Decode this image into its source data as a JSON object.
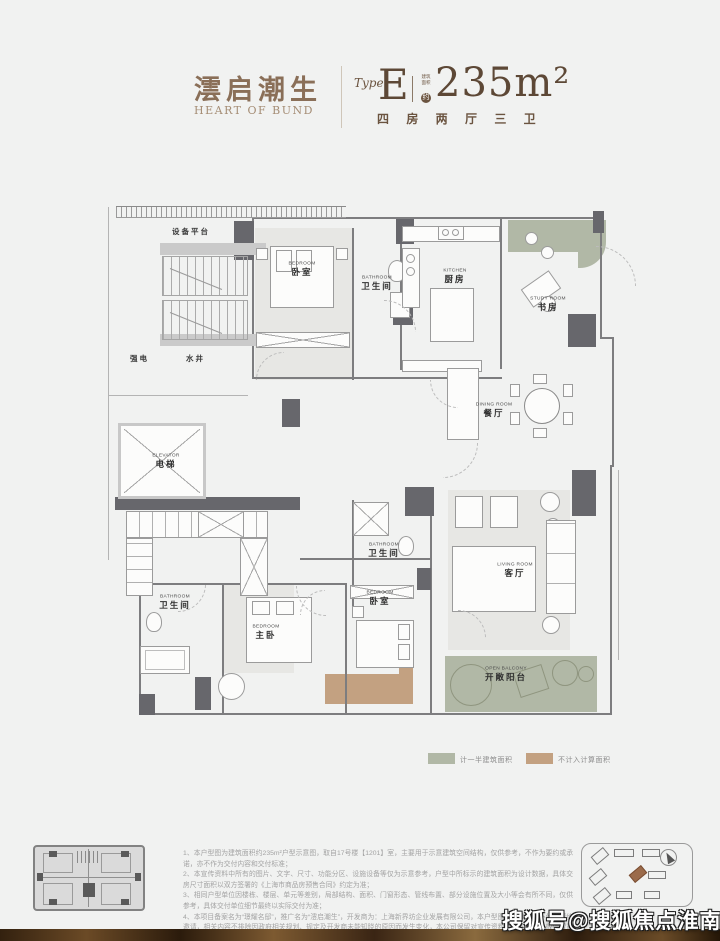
{
  "header": {
    "title_cn": "澐启潮生",
    "subtitle_en": "HEART OF BUND",
    "type_label": "Type",
    "type_value": "E",
    "area_badge_line1": "建筑",
    "area_badge_line2": "面积",
    "area_badge_circle": "约",
    "area_value": "235m²",
    "layout_desc": "四 房 两 厅 三 卫"
  },
  "plan": {
    "annotations": {
      "equipment_platform": "设备平台",
      "strong_electric": "强电",
      "water_well": "水井"
    },
    "rooms": [
      {
        "en": "BEDROOM",
        "cn": "卧室"
      },
      {
        "en": "BATHROOM",
        "cn": "卫生间"
      },
      {
        "en": "KITCHEN",
        "cn": "厨房"
      },
      {
        "en": "STUDY ROOM",
        "cn": "书房"
      },
      {
        "en": "DINING ROOM",
        "cn": "餐厅"
      },
      {
        "en": "ELEVATOR",
        "cn": "电梯"
      },
      {
        "en": "BATHROOM",
        "cn": "卫生间"
      },
      {
        "en": "LIVING ROOM",
        "cn": "客厅"
      },
      {
        "en": "BATHROOM",
        "cn": "卫生间"
      },
      {
        "en": "BEDROOM",
        "cn": "主卧"
      },
      {
        "en": "BEDROOM",
        "cn": "卧室"
      },
      {
        "en": "OPEN BALCONY",
        "cn": "开敞阳台"
      }
    ]
  },
  "legend": {
    "half_area": {
      "label": "计一半建筑面积",
      "color": "#b1b8a6"
    },
    "excluded_area": {
      "label": "不计入计算面积",
      "color": "#c3a181"
    }
  },
  "footer": {
    "notes": [
      "1、本户型图为建筑面积约235m²户型示意图，取自17号楼【1201】室，主要用于示意建筑空间结构，仅供参考，不作为要约或承诺，亦不作为交付内容和交付标准；",
      "2、本宣传资料中所有的图片、文字、尺寸、功能分区、设施设备等仅为示意参考，户型中所标示的建筑面积为设计数据，具体交房尺寸面积以双方签署的《上海市商品房预售合同》约定为准；",
      "3、相同户型单位因楼栋、楼层、单元等差别，局部结构、面积、门窗形态、管线布置、部分设施位置及大小等会有所不同，仅供参考，具体交付单位细节最终以实际交付为准；",
      "4、本项目备案名为“璟耀名邸”，推广名为“澐启潮生”，开发商为：上海新界坊企业发展有限公司，本户型图仅供参考，不作为要约邀请，相关内容不排除因政府相关规划、规定及开发商未能知晓的原因而发生变化，本公司保留对宣传资料修改的权利，敬请留意最新资料，本户型图制作时间为2026年1月。"
    ],
    "watermark": "搜狐号@搜狐焦点淮南站"
  }
}
